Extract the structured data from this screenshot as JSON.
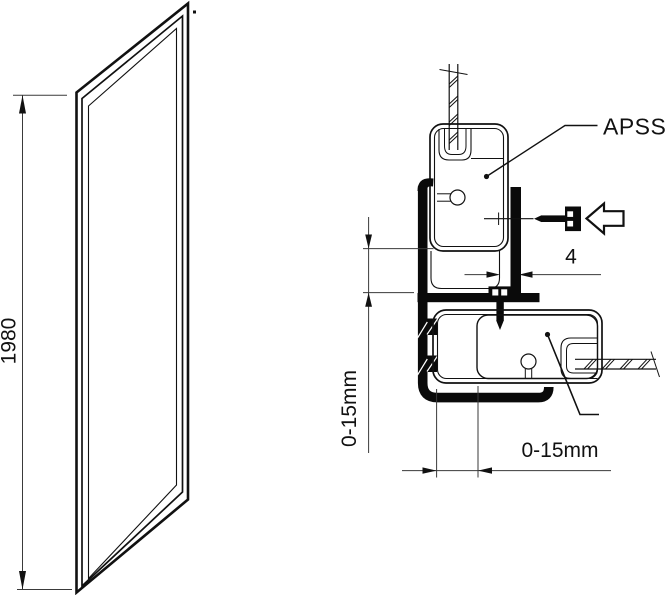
{
  "drawing": {
    "colors": {
      "line": "#111111",
      "thin_line": "#3a3a3a",
      "solid_fill": "#0a0a0a",
      "background": "#ffffff"
    },
    "labels": {
      "panel_height": "1980",
      "profile_name": "APSS",
      "screw_gap": "4",
      "vertical_adjustment": "0-15mm",
      "horizontal_adjustment": "0-15mm"
    },
    "icons": [
      {
        "name": "direction-arrow-icon"
      },
      {
        "name": "screw-horizontal-icon"
      },
      {
        "name": "screw-vertical-icon"
      }
    ]
  }
}
